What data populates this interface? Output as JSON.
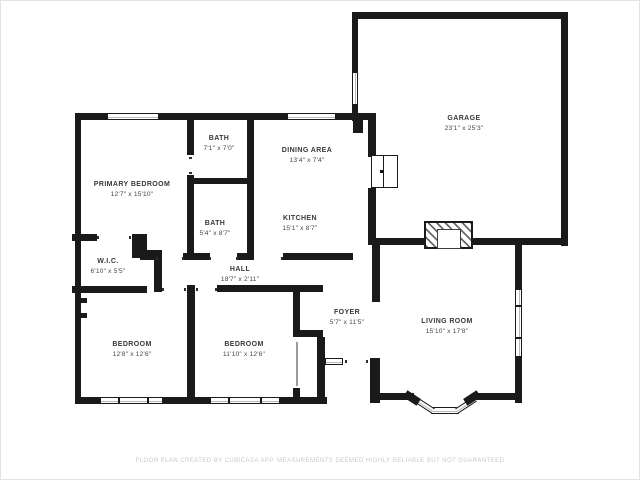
{
  "title": "floor-plan",
  "rooms": [
    {
      "id": "garage",
      "name": "GARAGE",
      "dims": "23'1\" x 25'3\""
    },
    {
      "id": "dining-area",
      "name": "DINING AREA",
      "dims": "13'4\" x 7'4\""
    },
    {
      "id": "bath-upper",
      "name": "BATH",
      "dims": "7'1\" x 7'0\""
    },
    {
      "id": "primary-bedroom",
      "name": "PRIMARY BEDROOM",
      "dims": "12'7\" x 15'10\""
    },
    {
      "id": "bath-lower",
      "name": "BATH",
      "dims": "5'4\" x 8'7\""
    },
    {
      "id": "kitchen",
      "name": "KITCHEN",
      "dims": "15'1\" x 8'7\""
    },
    {
      "id": "wic",
      "name": "W.I.C.",
      "dims": "6'10\" x 5'5\""
    },
    {
      "id": "hall",
      "name": "HALL",
      "dims": "18'7\" x 2'11\""
    },
    {
      "id": "foyer",
      "name": "FOYER",
      "dims": "5'7\" x 11'5\""
    },
    {
      "id": "living-room",
      "name": "LIVING ROOM",
      "dims": "15'10\" x 17'8\""
    },
    {
      "id": "bedroom-left",
      "name": "BEDROOM",
      "dims": "12'8\" x 12'6\""
    },
    {
      "id": "bedroom-right",
      "name": "BEDROOM",
      "dims": "11'10\" x 12'6\""
    }
  ],
  "features": {
    "fireplace": "fireplace",
    "bay_window": "bay-window",
    "garage_door": "garage-interior-door",
    "front_entry": "front-entry"
  },
  "footer": {
    "text": "FLOOR PLAN CREATED BY CUBICASA APP. MEASUREMENTS DEEMED HIGHLY RELIABLE BUT NOT GUARANTEED"
  },
  "colors": {
    "wall": "#1a1a1a",
    "background": "#ffffff",
    "footer_text": "#c9c9c9"
  }
}
